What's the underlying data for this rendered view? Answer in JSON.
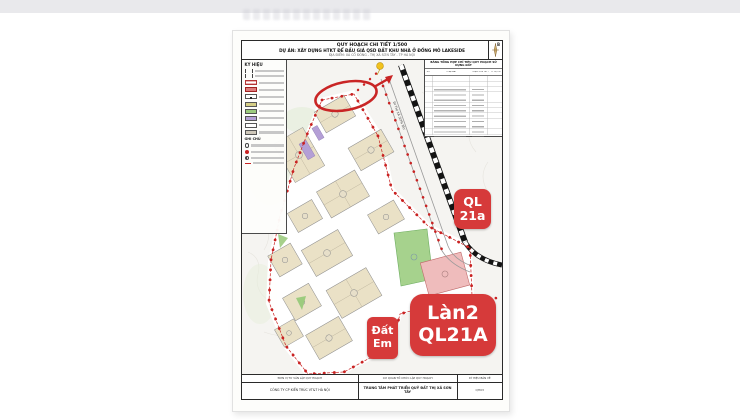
{
  "document": {
    "title_scale": "QUY HOẠCH CHI TIẾT 1/500",
    "title_project": "DỰ ÁN: XÂY DỰNG HTKT ĐỂ ĐẤU GIÁ QSD ĐẤT KHU NHÀ Ở ĐỒNG MÔ LAKESIDE",
    "title_location": "ĐỊA ĐIỂM: XÃ CỔ ĐÔNG - THỊ XÃ SƠN TÂY - TP HÀ NỘI",
    "compass_north": "B"
  },
  "legend": {
    "title": "KÝ HIỆU",
    "notes_title": "GHI CHÚ",
    "swatch_colors": [
      "#ffffff",
      "#dd7b7b",
      "#ffffff",
      "#d4cd85",
      "#9ccb7e",
      "#b49fd6",
      "#ffffff",
      "#cfc8ba"
    ]
  },
  "summary_table": {
    "title": "BẢNG TỔNG HỢP CHỈ TIÊU QUY HOẠCH SỬ DỤNG ĐẤT",
    "columns": [
      "STT",
      "LOẠI ĐẤT",
      "DIỆN TÍCH (m²)",
      "TỶ LỆ (%)"
    ]
  },
  "map": {
    "road_label": "ĐI THỊ XÃ SƠN TÂY"
  },
  "badges": [
    {
      "id": "ql21a",
      "lines": [
        "QL",
        "21a"
      ]
    },
    {
      "id": "lan2-ql21a",
      "lines": [
        "Làn2",
        "QL21A"
      ]
    },
    {
      "id": "dat-em",
      "lines": [
        "Đất",
        "Em"
      ]
    }
  ],
  "footer": {
    "columns": [
      {
        "header": "ĐƠN VỊ TƯ VẤN LẬP QUY HOẠCH",
        "value": "CÔNG TY CP KIẾN TRÚC VT&T HÀ NỘI"
      },
      {
        "header": "CƠ QUAN TỔ CHỨC LẬP QUY HOẠCH",
        "value": "TRUNG TÂM PHÁT TRIỂN QUỸ ĐẤT THỊ XÃ SƠN TÂY"
      },
      {
        "header": "KÝ HIỆU BẢN VẼ",
        "value": "QH03"
      }
    ]
  },
  "colors": {
    "annotation_badge_red": "#d63a3a",
    "boundary_red": "#c92222",
    "block_tan": "#eae1c6",
    "park_green": "#9ccb7e",
    "purple_land": "#b49fd6",
    "pink_block": "#efbcbc",
    "highway_black": "#141414",
    "marker_yellow": "#f2c21d"
  }
}
